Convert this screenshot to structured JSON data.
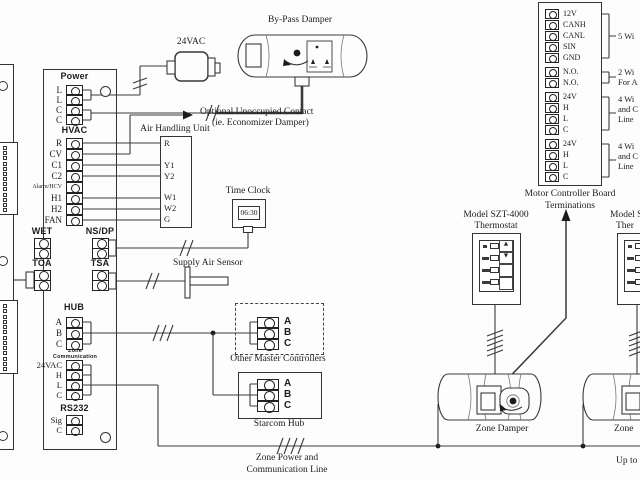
{
  "bypass_damper": {
    "label": "By-Pass Damper"
  },
  "transformer": {
    "label": "24VAC"
  },
  "optional_contact": {
    "line1": "Optional Unoccupied Contact",
    "line2": "(ie. Economizer Damper)"
  },
  "ahu": {
    "label": "Air Handling Unit",
    "terminals": [
      "R",
      "Y1",
      "Y2",
      "W1",
      "W2",
      "G"
    ]
  },
  "power": {
    "label": "Power",
    "terminals": [
      "L",
      "L",
      "C",
      "C"
    ]
  },
  "hvac": {
    "label": "HVAC",
    "terminals": [
      "R",
      "CV",
      "C1",
      "C2",
      "Alarm/HCV",
      "H1",
      "H2",
      "FAN"
    ]
  },
  "wet": {
    "label": "WET"
  },
  "nsdp": {
    "label": "NS/DP"
  },
  "toa": {
    "label": "TOA"
  },
  "tsa": {
    "label": "TSA"
  },
  "time_clock": {
    "label": "Time Clock",
    "display": "06:30"
  },
  "supply_air_sensor": {
    "label": "Supply Air Sensor"
  },
  "hub": {
    "label": "HUB",
    "terminals": [
      "A",
      "B",
      "C"
    ]
  },
  "zone_comm": {
    "label_line1": "Zone",
    "label_line2": "Communication",
    "terminals": [
      "24VAC",
      "H",
      "L",
      "C"
    ]
  },
  "rs232": {
    "label": "RS232",
    "terminals": [
      "Sig",
      "C"
    ]
  },
  "other_masters": {
    "label": "Other Master Controllers",
    "terminals": [
      "A",
      "B",
      "C"
    ]
  },
  "starcom": {
    "label": "Starcom Hub",
    "terminals": [
      "A",
      "B",
      "C"
    ]
  },
  "zone_bus": {
    "label_line1": "Zone Power and",
    "label_line2": "Communication Line"
  },
  "mcb": {
    "label_line1": "Motor Controller Board",
    "label_line2": "Terminations",
    "groups": [
      {
        "terminals": [
          "12V",
          "CANH",
          "CANL",
          "SIN",
          "GND"
        ],
        "note": [
          "5 Wi"
        ]
      },
      {
        "terminals": [
          "N.O.",
          "N.O."
        ],
        "note": [
          "2 Wi",
          "For A"
        ]
      },
      {
        "terminals": [
          "24V",
          "H",
          "L",
          "C"
        ],
        "note": [
          "4 Wi",
          "and C",
          "Line"
        ]
      },
      {
        "terminals": [
          "24V",
          "H",
          "L",
          "C"
        ],
        "note": [
          "4 Wi",
          "and C",
          "Line"
        ]
      }
    ]
  },
  "thermostat1": {
    "label_line1": "Model SZT-4000",
    "label_line2": "Thermostat"
  },
  "thermostat2": {
    "label_line1": "Model S",
    "label_line2": "Ther"
  },
  "thermostat_controls": {
    "up": "▲",
    "down": "▼"
  },
  "damper1": {
    "label": "Zone Damper"
  },
  "damper2": {
    "label": "Zone"
  },
  "up_to": {
    "label": "Up to"
  },
  "colors": {
    "line": "#3a3a3a",
    "text": "#1c1c1c",
    "background": "#fdfdfd"
  }
}
